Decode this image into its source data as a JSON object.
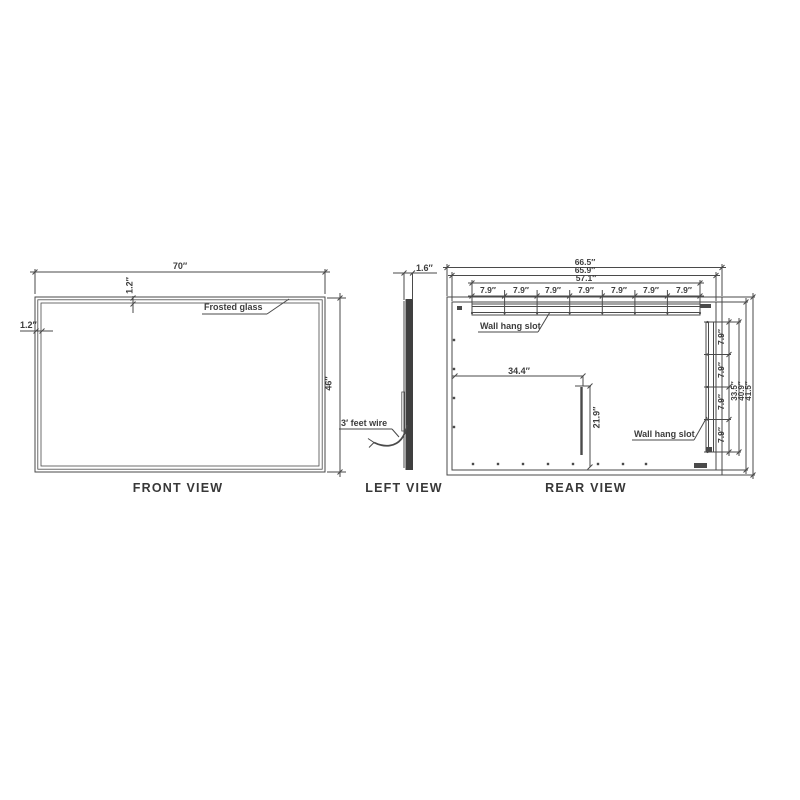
{
  "views": {
    "front": {
      "caption": "FRONT VIEW",
      "dims": {
        "width": "70″",
        "frame_top": "1.2″",
        "frame_left": "1.2″",
        "height": "46″"
      },
      "labels": {
        "glass": "Frosted glass"
      }
    },
    "left": {
      "caption": "LEFT VIEW",
      "dims": {
        "thickness": "1.6″"
      },
      "labels": {
        "wire": "3′ feet wire"
      }
    },
    "rear": {
      "caption": "REAR VIEW",
      "dims": {
        "overall_width": "66.5″",
        "inner_width": "65.9″",
        "slot_span": "57.1″",
        "top_segments": [
          "7.9″",
          "7.9″",
          "7.9″",
          "7.9″",
          "7.9″",
          "7.9″",
          "7.9″"
        ],
        "right_segments": [
          "7.9″",
          "7.9″",
          "7.9″",
          "7.9″"
        ],
        "slot_height": "33.5″",
        "inner_height": "40.9″",
        "overall_height": "41.5″",
        "hole_offset_x": "34.4″",
        "hole_offset_y": "21.9″"
      },
      "labels": {
        "wall_hang_slot_top": "Wall hang slot",
        "wall_hang_slot_right": "Wall hang slot"
      }
    }
  },
  "colors": {
    "line": "#4a4a4a",
    "panel_fill": "#3f3f3f",
    "text": "#3d3d3d",
    "background": "#ffffff"
  }
}
